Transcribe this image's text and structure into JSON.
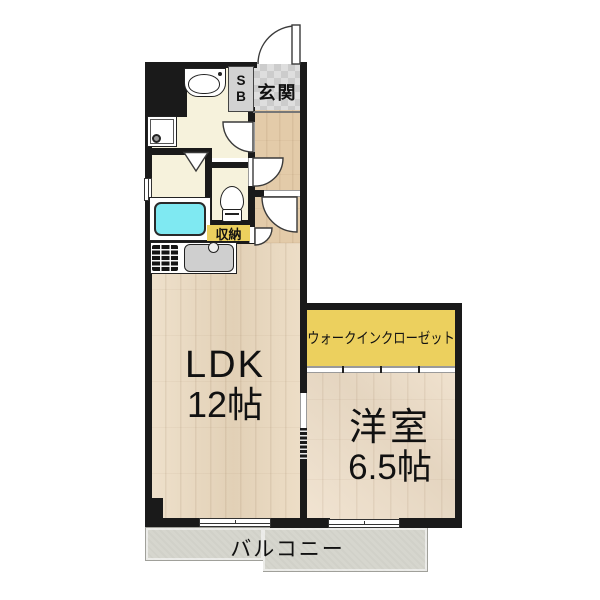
{
  "plan": {
    "rooms": {
      "entrance": {
        "label": "玄関"
      },
      "shoe_box": {
        "line1": "S",
        "line2": "B"
      },
      "storage": {
        "label": "収納"
      },
      "walk_in_closet": {
        "label": "ウォークインクローゼット"
      },
      "ldk": {
        "label": "LDK",
        "size": "12帖"
      },
      "western_room": {
        "label": "洋室",
        "size": "6.5帖"
      },
      "balcony": {
        "label": "バルコニー"
      }
    },
    "fixtures": [
      "bathtub",
      "toilet",
      "wash-basin",
      "washing-machine-pan",
      "kitchen-sink",
      "gas-stove",
      "shoe-box"
    ],
    "colors": {
      "wall": "#1a1a1a",
      "wood_ldk": "#ead8bd",
      "wood_hall": "#e3cba9",
      "wood_western": "#eedec8",
      "cream": "#f6f2dc",
      "tile": "#d6d6d6",
      "tub": "#7fe9f2",
      "accent_yellow": "#ecd05e",
      "balcony": "#d6d6ce",
      "fixture_gray": "#cfcfcf"
    }
  }
}
